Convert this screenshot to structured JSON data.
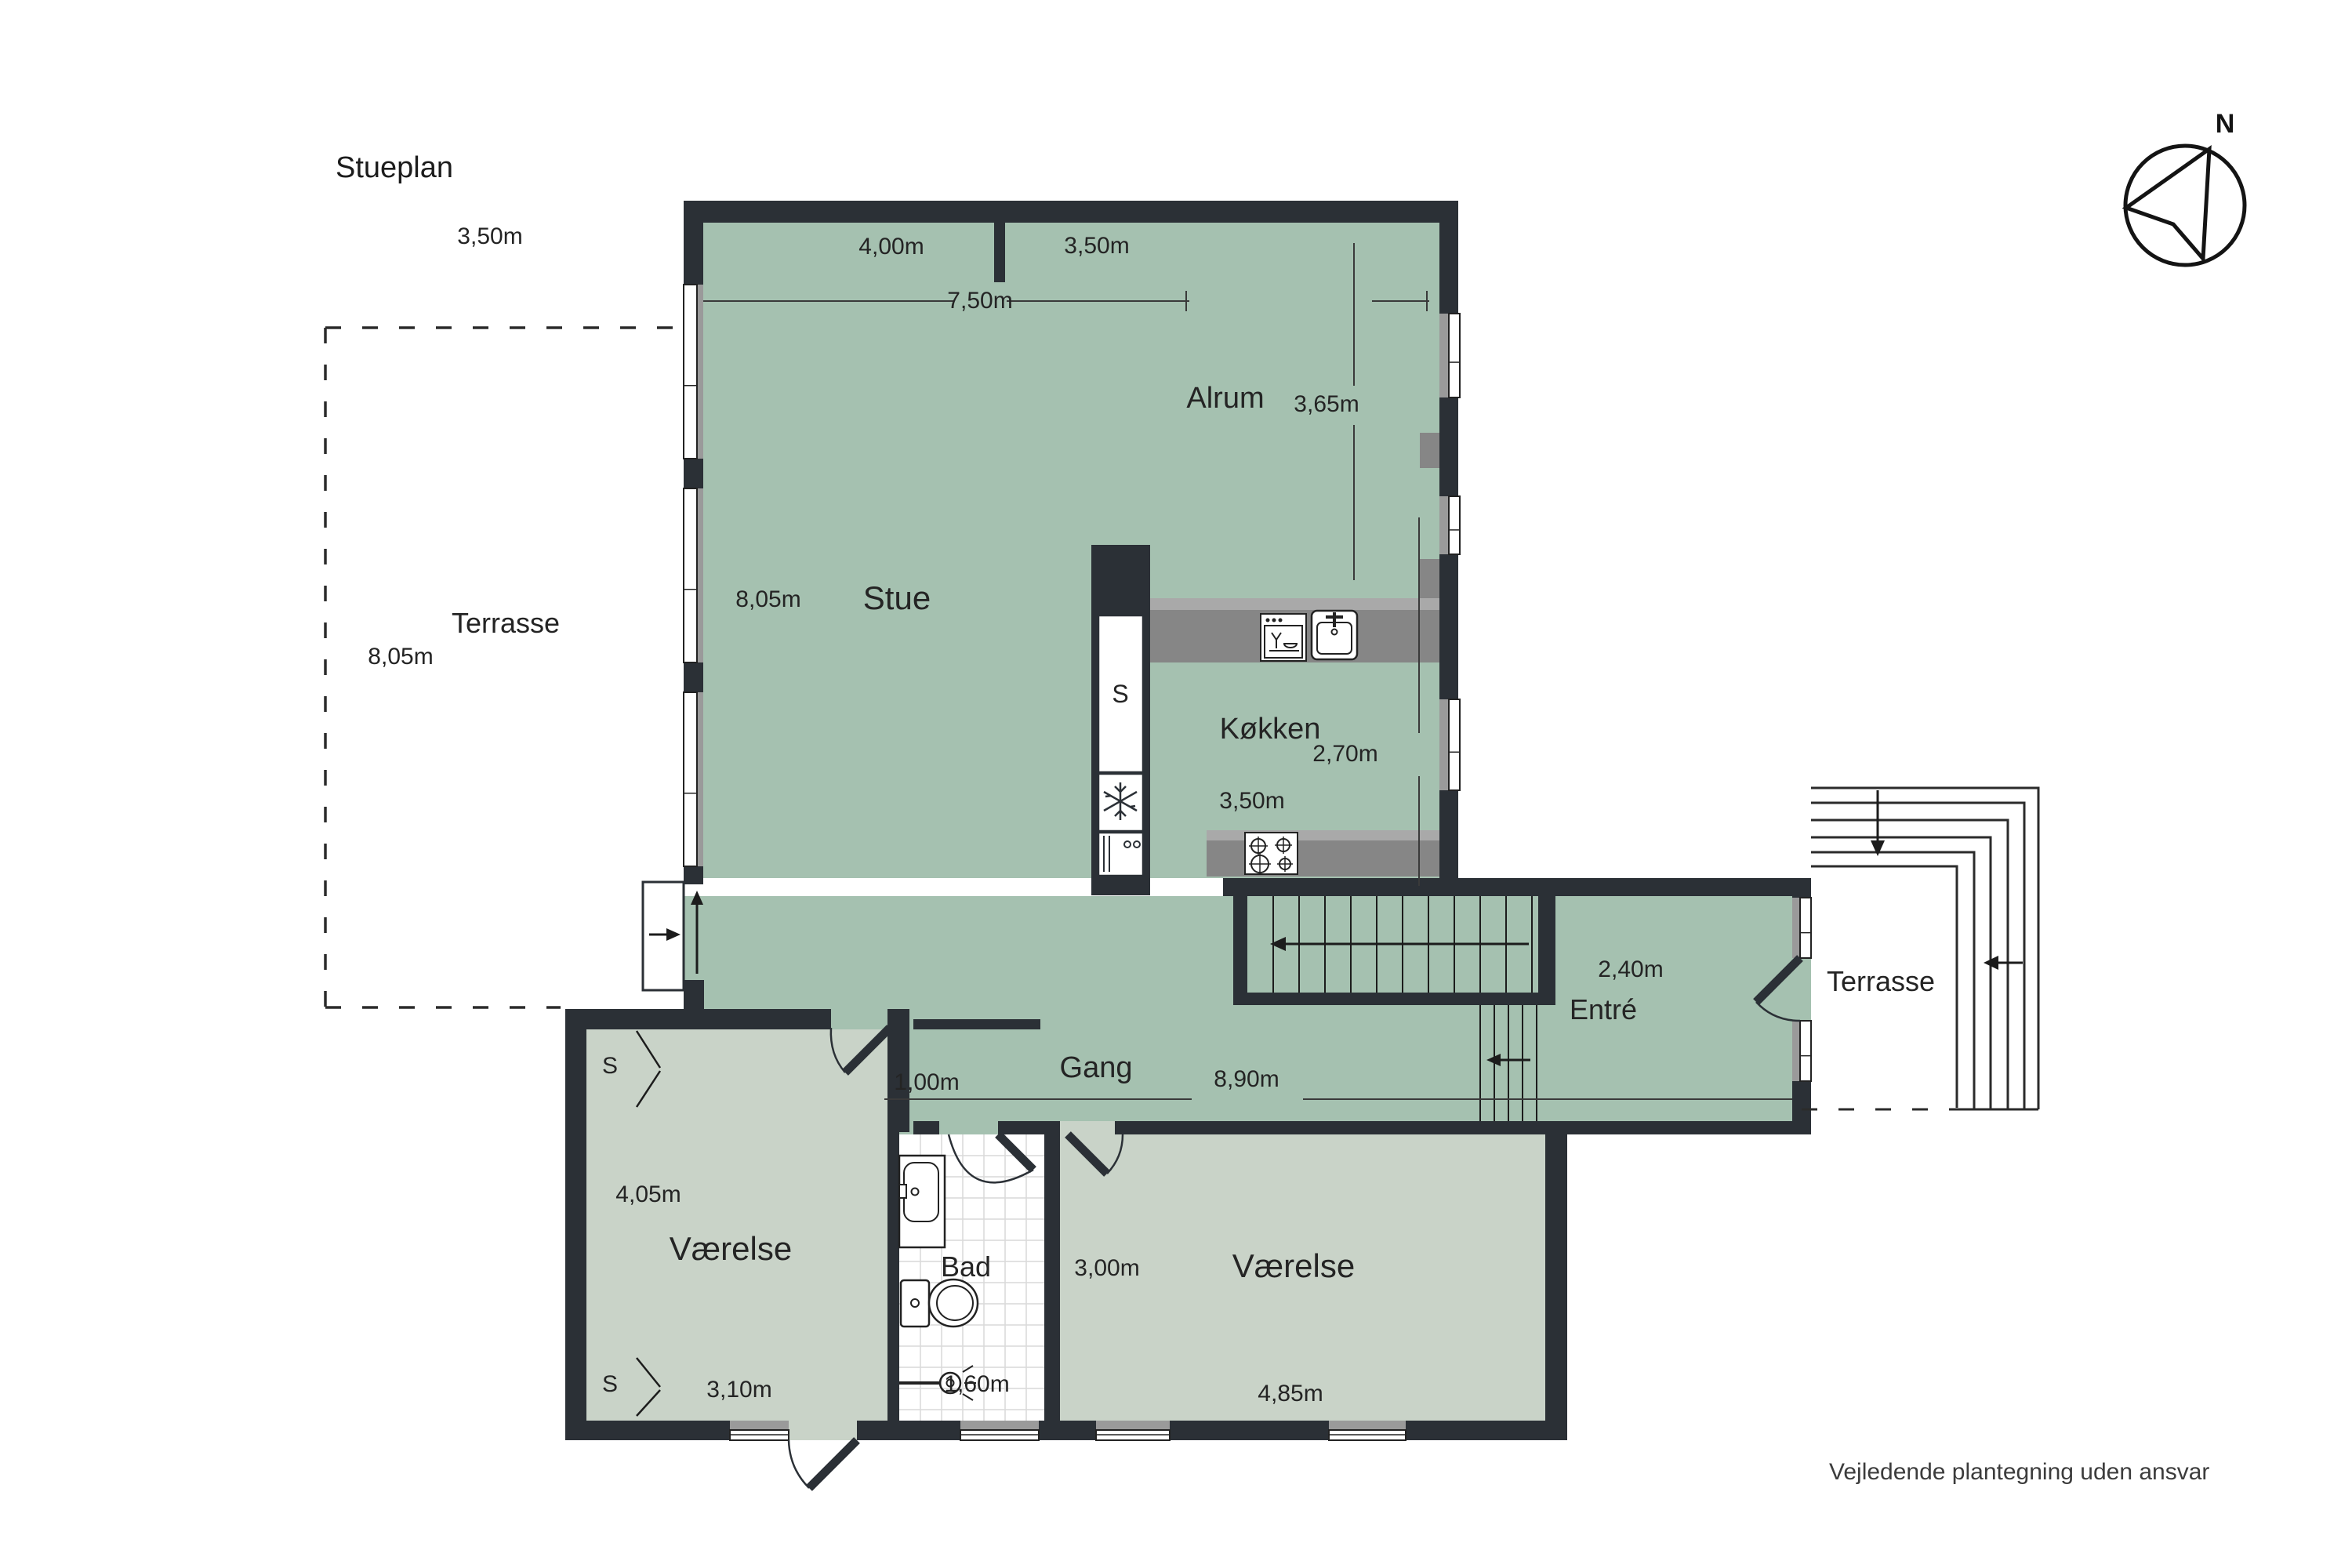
{
  "title": {
    "text": "Stueplan"
  },
  "footer": {
    "text": "Vejledende plantegning uden ansvar"
  },
  "compass": {
    "letter": "N",
    "icon": "compass-north-icon"
  },
  "colors": {
    "wall": "#2b3036",
    "room_green": "#a5c1b0",
    "room_gray_green": "#c9d3c8",
    "counter": "#868686",
    "counter_light": "#a9a9a9",
    "window_gray": "#9a9a9a",
    "tile_line": "#d9d9d9",
    "dim_line": "#3a3a3a"
  },
  "rooms": {
    "stue": {
      "label": "Stue"
    },
    "alrum": {
      "label": "Alrum"
    },
    "kokken": {
      "label": "Køkken"
    },
    "gang": {
      "label": "Gang"
    },
    "entre": {
      "label": "Entré"
    },
    "bad": {
      "label": "Bad"
    },
    "vaerelse_left": {
      "label": "Værelse"
    },
    "vaerelse_right": {
      "label": "Værelse"
    },
    "terrasse_west": {
      "label": "Terrasse"
    },
    "terrasse_east": {
      "label": "Terrasse"
    },
    "closet": {
      "label": "S"
    }
  },
  "labels": {
    "terr_w_350": {
      "text": "3,50m"
    },
    "terr_w_name": {
      "text": "Terrasse"
    },
    "terr_w_805": {
      "text": "8,05m"
    },
    "dim_400": {
      "text": "4,00m"
    },
    "dim_350_alrum": {
      "text": "3,50m"
    },
    "dim_750": {
      "text": "7,50m"
    },
    "alrum": {
      "text": "Alrum"
    },
    "dim_365": {
      "text": "3,65m"
    },
    "stue_805": {
      "text": "8,05m"
    },
    "stue": {
      "text": "Stue"
    },
    "kokken": {
      "text": "Køkken"
    },
    "dim_270": {
      "text": "2,70m"
    },
    "kok_350": {
      "text": "3,50m"
    },
    "island_s": {
      "text": "S"
    },
    "entre": {
      "text": "Entré"
    },
    "dim_240": {
      "text": "2,40m"
    },
    "terr_e_name": {
      "text": "Terrasse"
    },
    "gang": {
      "text": "Gang"
    },
    "dim_100": {
      "text": "1,00m"
    },
    "dim_890": {
      "text": "8,90m"
    },
    "closet_s1": {
      "text": "S"
    },
    "closet_s2": {
      "text": "S"
    },
    "dim_405": {
      "text": "4,05m"
    },
    "vaer_l": {
      "text": "Værelse"
    },
    "dim_310": {
      "text": "3,10m"
    },
    "bad": {
      "text": "Bad"
    },
    "dim_160": {
      "text": "1,60m"
    },
    "dim_300": {
      "text": "3,00m"
    },
    "vaer_r": {
      "text": "Værelse"
    },
    "dim_485": {
      "text": "4,85m"
    }
  },
  "icons": [
    "compass-north-icon",
    "snowflake-freezer-icon",
    "oven-icon",
    "stove-burners-icon",
    "dishwasher-icon",
    "kitchen-sink-icon",
    "bath-sink-icon",
    "toilet-icon",
    "shower-icon",
    "entry-step-icon",
    "stair-direction-arrows",
    "terrace-step-arrows",
    "door-swing-symbols",
    "window-symbols"
  ]
}
